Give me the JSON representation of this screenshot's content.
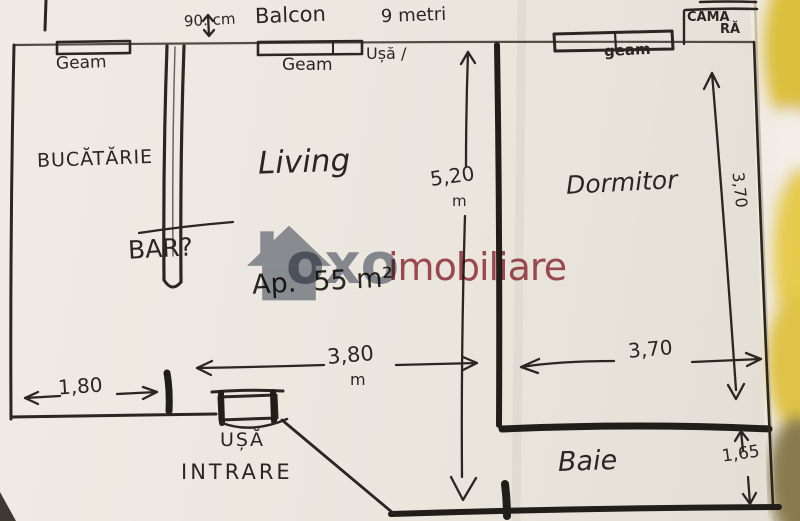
{
  "watermark": {
    "brand": "oxo",
    "suffix": "imobiliare",
    "house_icon_color": "#848b98",
    "brand_color": "#7f8694",
    "suffix_color": "#9c3742"
  },
  "plan": {
    "area_label": "Ap.  55 m²",
    "balcony": {
      "width": "90. cm",
      "label": "Balcon",
      "length": "9 metri"
    },
    "pantry": {
      "line1": "CĂMA",
      "line2": "RĂ"
    },
    "rooms": {
      "kitchen": "BUCĂTĂRIE",
      "living": "Living",
      "bar": "BAR?",
      "bedroom": "Dormitor",
      "bathroom": "Baie"
    },
    "windows": {
      "kitchen": "Geam",
      "living": "Geam",
      "bedroom": "geam"
    },
    "doors": {
      "balcony": "Ușă /",
      "entrance_line1": "UȘĂ",
      "entrance_line2": "INTRARE"
    },
    "dims": {
      "living_height": "5,20",
      "living_height_unit": "m",
      "living_width": "3,80",
      "living_width_unit": "m",
      "kitchen_front": "1,80",
      "bedroom_width": "3,70",
      "bedroom_depth": "3,70",
      "bathroom_depth": "1,65"
    },
    "ink_color": "#2b2620",
    "paper_color": "#eae6df"
  }
}
